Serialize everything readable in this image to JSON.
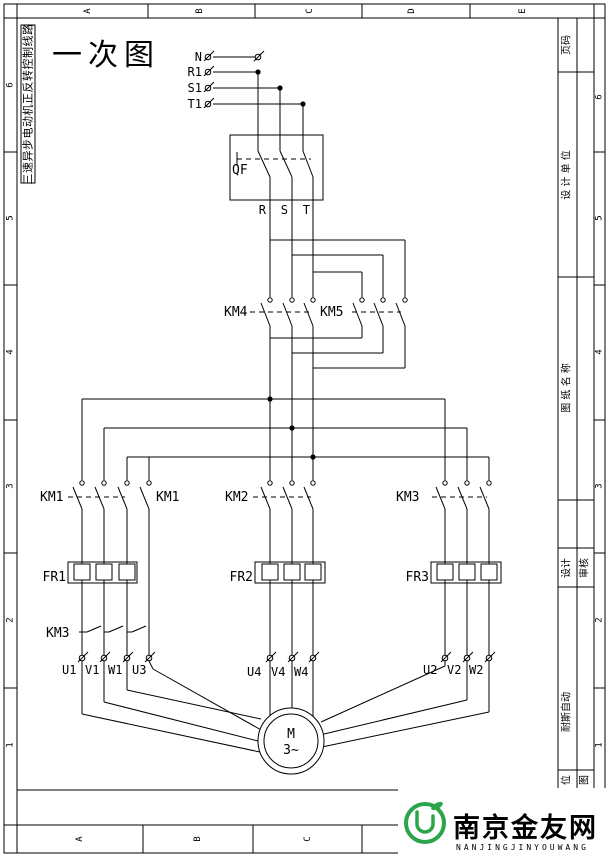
{
  "frame": {
    "top_letters": [
      "A",
      "B",
      "C",
      "D",
      "E"
    ],
    "bottom_letters": [
      "A",
      "B",
      "C"
    ],
    "left_numbers": [
      "6",
      "5",
      "4",
      "3",
      "2",
      "1"
    ],
    "right_numbers": [
      "6",
      "5",
      "4",
      "3",
      "2",
      "1"
    ]
  },
  "title_block": {
    "page_no": "页码",
    "design_unit": "设 计 单 位",
    "drawing_name": "图 纸 名 称",
    "design": "设计",
    "review": "审核",
    "company": "耐斯自动",
    "unit_cell": "位",
    "drawing_cell": "图"
  },
  "drawing": {
    "side_title": "三速异步电动机正反转控制线路",
    "main_title": "一次图",
    "terminals_in": {
      "n": "N",
      "r1": "R1",
      "s1": "S1",
      "t1": "T1"
    },
    "breaker": "QF",
    "phases": {
      "r": "R",
      "s": "S",
      "t": "T"
    },
    "contactors": {
      "km4": "KM4",
      "km5": "KM5",
      "km1a": "KM1",
      "km1b": "KM1",
      "km2": "KM2",
      "km3": "KM3",
      "km3_star": "KM3"
    },
    "relays": {
      "fr1": "FR1",
      "fr2": "FR2",
      "fr3": "FR3"
    },
    "motor_terminals": {
      "u1": "U1",
      "v1": "V1",
      "w1": "W1",
      "u3": "U3",
      "u4": "U4",
      "v4": "V4",
      "w4": "W4",
      "u2": "U2",
      "v2": "V2",
      "w2": "W2"
    },
    "motor": {
      "m": "M",
      "phase": "3~"
    }
  },
  "watermark": {
    "name": "南京金友网",
    "subtext": "NANJINGJINYOUWANG",
    "green": "#2ca54a",
    "dark": "#4b4b52",
    "gray": "#8f9094"
  }
}
